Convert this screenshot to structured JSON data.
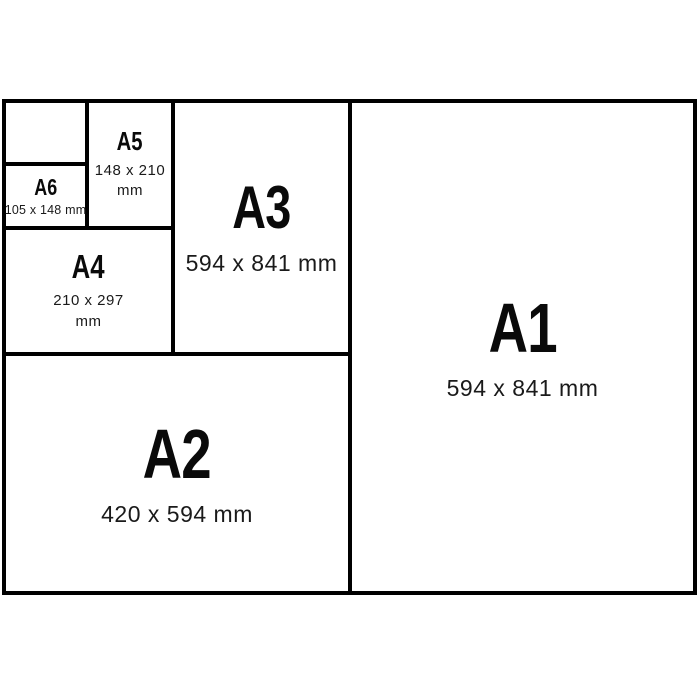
{
  "page": {
    "background_color": "#ffffff",
    "line_color": "#000000",
    "text_color": "#0a0a0a"
  },
  "diagram": {
    "description": "Nested paper size comparison chart",
    "sheets": [
      {
        "id": "blank",
        "label": "",
        "dims": ""
      },
      {
        "id": "a6",
        "label": "A6",
        "dims": "105 x 148 mm"
      },
      {
        "id": "a5",
        "label": "A5",
        "dims": "148 x 210 mm"
      },
      {
        "id": "a4",
        "label": "A4",
        "dims": "210 x 297 mm"
      },
      {
        "id": "a3",
        "label": "A3",
        "dims": "594 x 841 mm"
      },
      {
        "id": "a2",
        "label": "A2",
        "dims": "420 x 594 mm"
      },
      {
        "id": "a1",
        "label": "A1",
        "dims": "594 x 841 mm"
      }
    ]
  }
}
